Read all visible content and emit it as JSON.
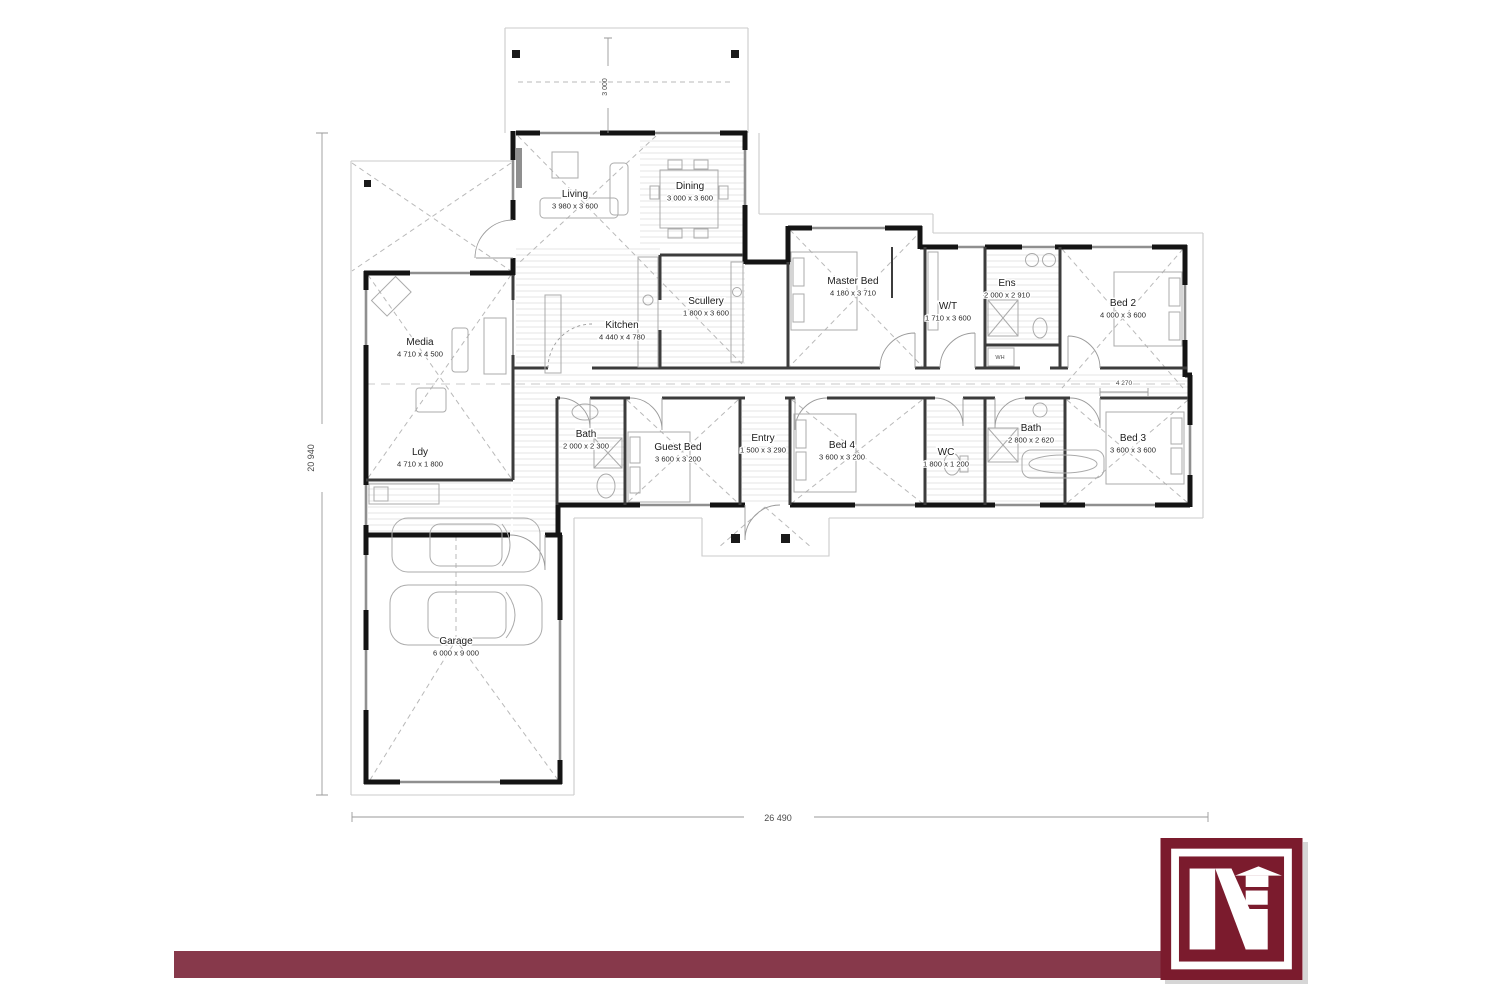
{
  "plan": {
    "rooms": [
      {
        "id": "living",
        "name": "Living",
        "dims": "3 980 x 3 600",
        "x": 575,
        "y": 197
      },
      {
        "id": "dining",
        "name": "Dining",
        "dims": "3 000 x 3 600",
        "x": 690,
        "y": 189
      },
      {
        "id": "scullery",
        "name": "Scullery",
        "dims": "1 800 x 3 600",
        "x": 706,
        "y": 304
      },
      {
        "id": "kitchen",
        "name": "Kitchen",
        "dims": "4 440 x 4 780",
        "x": 622,
        "y": 328
      },
      {
        "id": "media",
        "name": "Media",
        "dims": "4 710 x 4 500",
        "x": 420,
        "y": 345
      },
      {
        "id": "master-bed",
        "name": "Master Bed",
        "dims": "4 180 x 3 710",
        "x": 853,
        "y": 284
      },
      {
        "id": "walk-through-robe",
        "name": "W/T",
        "dims": "1 710 x 3 600",
        "x": 948,
        "y": 309
      },
      {
        "id": "ensuite",
        "name": "Ens",
        "dims": "2 000 x 2 910",
        "x": 1007,
        "y": 286
      },
      {
        "id": "bed2",
        "name": "Bed 2",
        "dims": "4 000 x 3 600",
        "x": 1123,
        "y": 306
      },
      {
        "id": "bath1",
        "name": "Bath",
        "dims": "2 000 x 2 300",
        "x": 586,
        "y": 437
      },
      {
        "id": "guest-bed",
        "name": "Guest Bed",
        "dims": "3 600 x 3 200",
        "x": 678,
        "y": 450
      },
      {
        "id": "entry",
        "name": "Entry",
        "dims": "1 500 x 3 290",
        "x": 763,
        "y": 441
      },
      {
        "id": "bed4",
        "name": "Bed 4",
        "dims": "3 600 x 3 200",
        "x": 842,
        "y": 448
      },
      {
        "id": "wc",
        "name": "WC",
        "dims": "1 800 x 1 200",
        "x": 946,
        "y": 455
      },
      {
        "id": "bath2",
        "name": "Bath",
        "dims": "2 800 x 2 620",
        "x": 1031,
        "y": 431
      },
      {
        "id": "bed3",
        "name": "Bed 3",
        "dims": "3 600 x 3 600",
        "x": 1133,
        "y": 441
      },
      {
        "id": "laundry",
        "name": "Ldy",
        "dims": "4 710 x 1 800",
        "x": 420,
        "y": 455
      },
      {
        "id": "garage",
        "name": "Garage",
        "dims": "6 000 x 9 000",
        "x": 456,
        "y": 644
      }
    ],
    "annotations": [
      {
        "id": "dim-left",
        "text": "20 940",
        "x": 314,
        "y": 458,
        "rotate": -90,
        "size": 9
      },
      {
        "id": "dim-top",
        "text": "3 000",
        "x": 607,
        "y": 87,
        "rotate": -90,
        "size": 7
      },
      {
        "id": "dim-bottom",
        "text": "26 490",
        "x": 778,
        "y": 821,
        "rotate": 0,
        "size": 9
      },
      {
        "id": "dim-step",
        "text": "4 270",
        "x": 1124,
        "y": 385,
        "rotate": 0,
        "size": 6.5
      },
      {
        "id": "water-heater",
        "text": "WH",
        "x": 1000,
        "y": 359,
        "rotate": 0,
        "size": 5.5
      }
    ]
  },
  "branding": {
    "footer_bar_color": "#87394B",
    "logo_color": "#7B1B2D",
    "logo_monogram": "N",
    "logo_icon": "house-arrow-icon"
  }
}
